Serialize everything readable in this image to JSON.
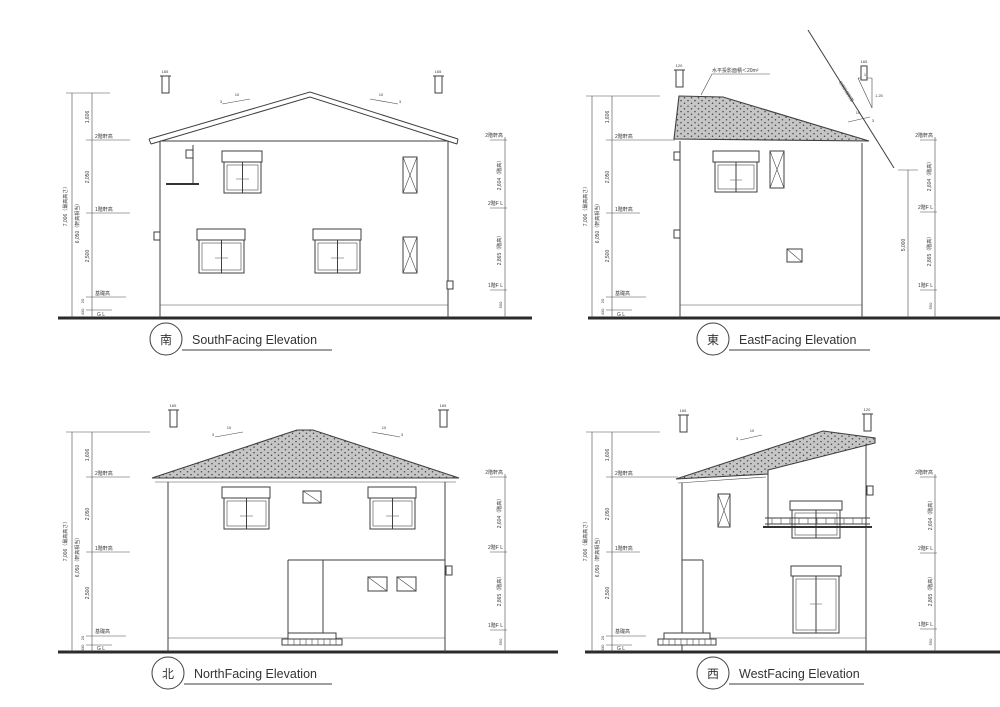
{
  "page": {
    "background": "#ffffff",
    "line_color": "#3f3f3f",
    "roof_fill": "#c6c6c6",
    "roof_dot": "#474747",
    "text_color": "#3a3a3a"
  },
  "labels": {
    "south": {
      "kanji": "南",
      "title": "SouthFacing Elevation"
    },
    "east": {
      "kanji": "東",
      "title": "EastFacing Elevation"
    },
    "north": {
      "kanji": "北",
      "title": "NorthFacing Elevation"
    },
    "west": {
      "kanji": "西",
      "title": "WestFacing Elevation"
    }
  },
  "dims": {
    "total_max": "7,006（最高高さ）",
    "total_eave": "6,050（軒高相当）",
    "seg_top": "1,606",
    "seg_mid": "2,050",
    "seg_low": "2,500",
    "seg_plinth": "20",
    "seg_base": "430",
    "eave2f": "2階軒高",
    "eave1f": "1階軒高",
    "foundation": "基礎高",
    "gl": "G L",
    "fl2": "2階F L",
    "fl1": "1階F L",
    "story_upper": "2,604（階高）",
    "story_lower": "2,865（階高）",
    "fl1_height": "550",
    "east_height": "5,000",
    "vent_a": "165",
    "vent_b": "120",
    "pitch_run": "10",
    "pitch_rise": "3",
    "slope_run": "1",
    "slope_rise": "1.25"
  },
  "annotations": {
    "roof_area": "水平投影面積＜20m²",
    "setback": "北側斜線制限"
  }
}
